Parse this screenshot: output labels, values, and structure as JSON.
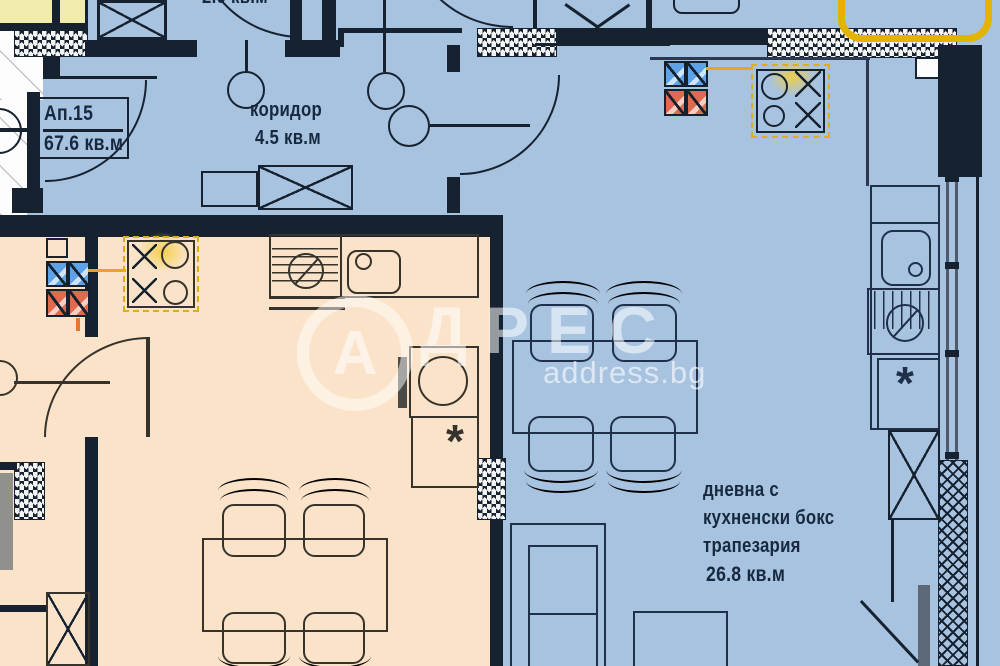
{
  "plan": {
    "apartment": {
      "label": "Ап.15",
      "area": "67.6 кв.м"
    },
    "corridor": {
      "name": "коридор",
      "area": "4.5 кв.м"
    },
    "living": {
      "line1": "дневна с",
      "line2": "кухненски бокс",
      "line3": "трапезария",
      "area": "26.8 кв.м"
    },
    "top_partial_area": "2.0 кв.м",
    "fridge_symbol": "*",
    "watermark": {
      "letter": "А",
      "rest": "ДРЕС",
      "site": "address.bg"
    },
    "colors": {
      "floor_main": "#a7c3e0",
      "floor_adjacent": "#fbe3c9",
      "wall": "#16222f",
      "highlight_yellow": "#d9b01c",
      "shaft_blue": "#5ea3e8",
      "shaft_red": "#e06a4e",
      "adjacent_unit_yellow": "#f1ecae",
      "watermark_white": "rgba(255,255,255,0.55)"
    },
    "icons": [
      {
        "name": "stove-burner-o",
        "glyph": "○"
      },
      {
        "name": "stove-burner-x",
        "glyph": "✕"
      },
      {
        "name": "fridge-asterisk",
        "glyph": "*"
      },
      {
        "name": "washing-machine",
        "glyph": "⊘"
      }
    ]
  }
}
